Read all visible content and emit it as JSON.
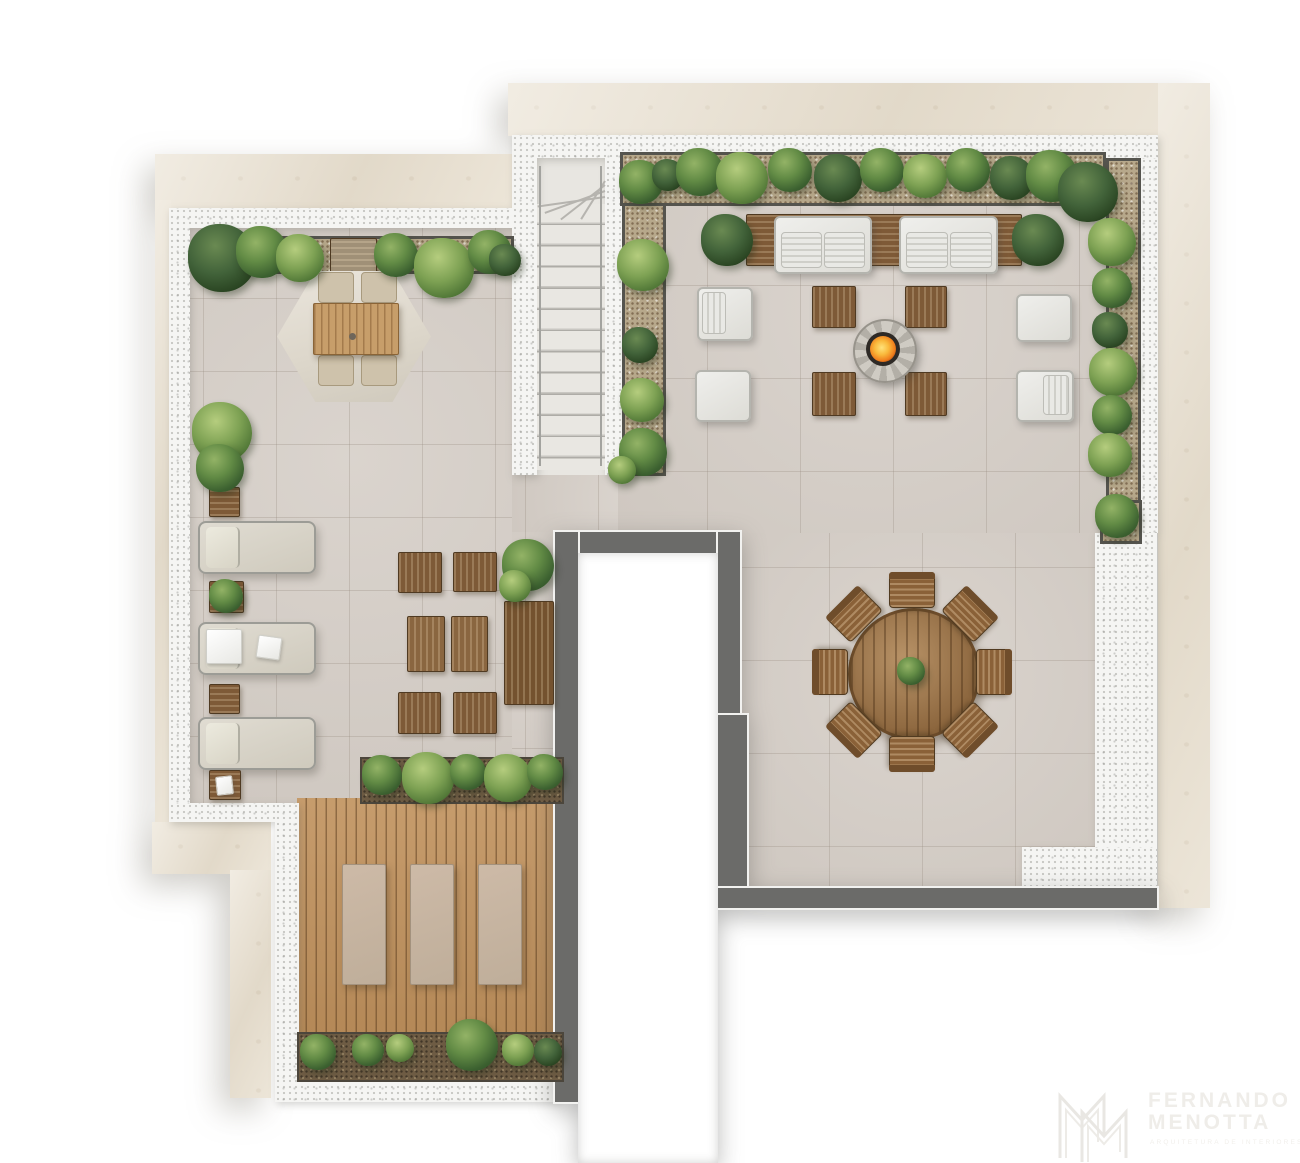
{
  "watermark": {
    "monogram": "M",
    "brand_line1": "FERNANDO",
    "brand_line2": "MENOTTA",
    "tagline": "ARQUITETURA DE INTERIORES"
  },
  "palette": {
    "canvas": "#ffffff",
    "stone_border": "#eae2d3",
    "speckled_wall": "#f5f5f3",
    "tile_floor": "#d6cfc8",
    "dark_parapet": "#6b6b69",
    "deck_wood": "#c0915c",
    "furniture_wood": "#7e5a37",
    "light_wood_table": "#c79e6a",
    "upholstery": "#e9e8e4",
    "foliage_green": "#628b45",
    "foliage_dark": "#42633a",
    "gravel": "#b7a88b",
    "fire": "#f9b93c"
  },
  "plan": {
    "type": "rooftop-terrace-floor-plan",
    "areas": [
      {
        "name": "parasol-dining-terrace",
        "furniture": [
          "hexagonal cantilever parasol",
          "wood dining table",
          "4 dining chairs",
          "perimeter planter"
        ]
      },
      {
        "name": "sun-lounger-row",
        "furniture": [
          "3 sun loungers",
          "3 wood side tables",
          "potted plant",
          "towels",
          "magazine"
        ]
      },
      {
        "name": "stool-lounge-group",
        "furniture": [
          "4 wood stools",
          "2 wood low tables",
          "wood console table",
          "potted plant"
        ]
      },
      {
        "name": "staircase",
        "details": [
          "straight flight with winder landing",
          "handrails both sides"
        ]
      },
      {
        "name": "fire-pit-lounge",
        "furniture": [
          "2 outdoor sofas on wood bench",
          "4 square wood coffee tables",
          "round fire pit with flame",
          "4 lounge chairs",
          "2 end planters"
        ]
      },
      {
        "name": "round-dining-area",
        "furniture": [
          "round wood table",
          "8 slatted wood chairs",
          "centerpiece plant"
        ]
      },
      {
        "name": "sunbathing-deck",
        "furniture": [
          "timber deck",
          "3 sunbathing mats",
          "2 deck planters"
        ]
      },
      {
        "name": "void-opening",
        "details": [
          "open-to-below void framed by dark parapet walls"
        ]
      }
    ]
  }
}
